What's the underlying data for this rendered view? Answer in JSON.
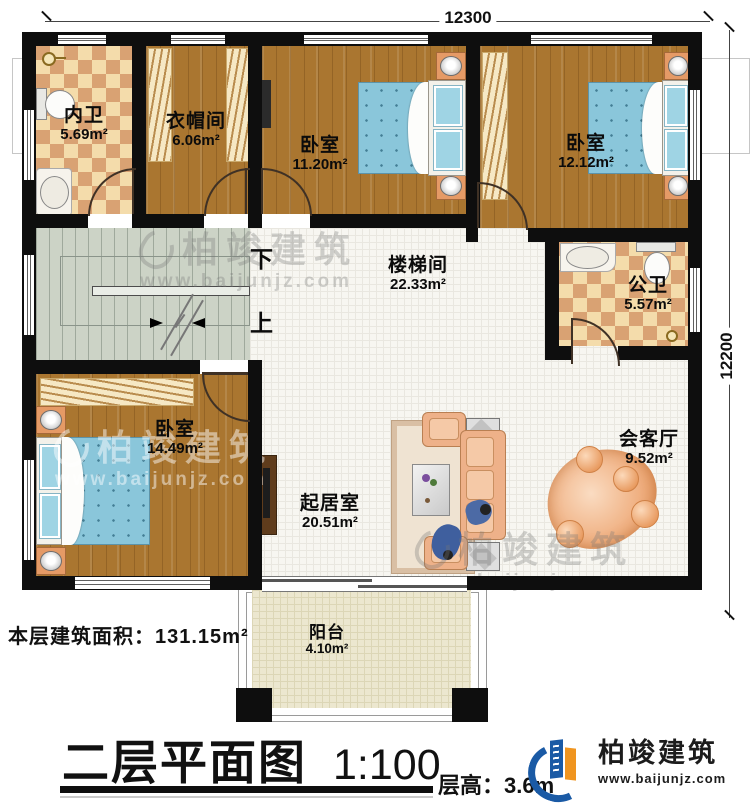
{
  "page": {
    "footer_area": "本层建筑面积：131.15m²",
    "title": "二层平面图",
    "scale": "1:100",
    "floor_height": "层高：3.6m"
  },
  "dimensions": {
    "top": "12300",
    "right": "12200"
  },
  "stairs": {
    "down": "下",
    "up": "上"
  },
  "brand": {
    "name": "柏竣建筑",
    "website": "www.baijunjz.com"
  },
  "rooms": [
    {
      "name": "内卫",
      "area": "5.69m²"
    },
    {
      "name": "衣帽间",
      "area": "6.06m²"
    },
    {
      "name": "卧室",
      "area": "11.20m²"
    },
    {
      "name": "卧室",
      "area": "12.12m²"
    },
    {
      "name": "楼梯间",
      "area": "22.33m²"
    },
    {
      "name": "公卫",
      "area": "5.57m²"
    },
    {
      "name": "卧室",
      "area": "14.49m²"
    },
    {
      "name": "起居室",
      "area": "20.51m²"
    },
    {
      "name": "会客厅",
      "area": "9.52m²"
    },
    {
      "name": "阳台",
      "area": "4.10m²"
    }
  ]
}
